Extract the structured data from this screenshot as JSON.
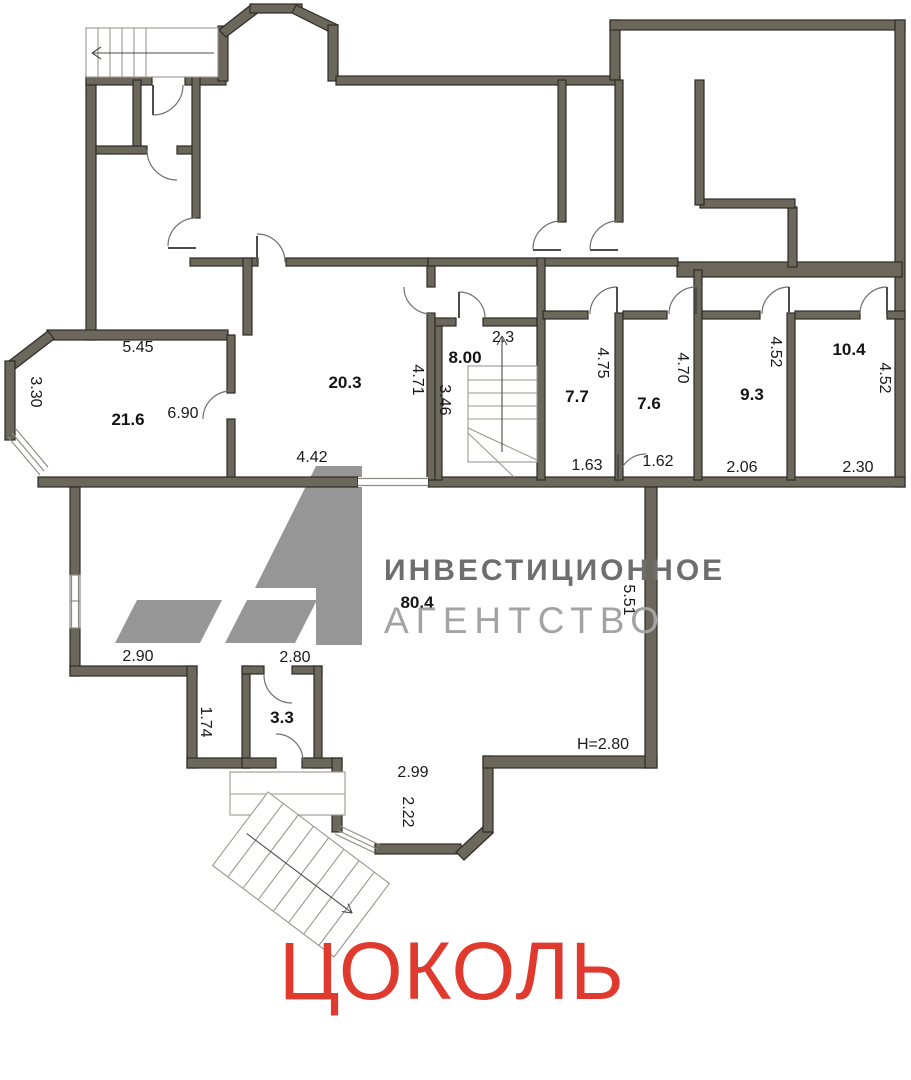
{
  "meta": {
    "floor_title": "ЦОКОЛЬ",
    "plan_type": "floor-plan"
  },
  "watermark": {
    "logo": "A1",
    "brand_line1": "ИНВЕСТИЦИОННОЕ",
    "brand_line2": "АГЕНТСТВО"
  },
  "colors": {
    "wall_fill": "#6b675a",
    "wall_outline": "#2e2c27",
    "title_red": "#e03a2f",
    "logo_gray": "#8e8e8e",
    "brand_dark_gray": "#6e6e6e",
    "brand_light_gray": "#a3a3a3",
    "label_text": "#141414"
  },
  "rooms": [
    {
      "area": "21.6",
      "x": 128,
      "y": 420
    },
    {
      "area": "20.3",
      "x": 345,
      "y": 383
    },
    {
      "area": "8.00",
      "x": 465,
      "y": 358
    },
    {
      "area": "7.7",
      "x": 577,
      "y": 397
    },
    {
      "area": "7.6",
      "x": 649,
      "y": 404
    },
    {
      "area": "9.3",
      "x": 752,
      "y": 395
    },
    {
      "area": "10.4",
      "x": 849,
      "y": 350
    },
    {
      "area": "80.4",
      "x": 417,
      "y": 603
    },
    {
      "area": "3.3",
      "x": 282,
      "y": 718
    }
  ],
  "dimensions": [
    {
      "value": "5.45",
      "x": 138,
      "y": 348,
      "vertical": false
    },
    {
      "value": "3.30",
      "x": 35,
      "y": 392,
      "vertical": true
    },
    {
      "value": "6.90",
      "x": 183,
      "y": 414,
      "vertical": false
    },
    {
      "value": "4.42",
      "x": 312,
      "y": 458,
      "vertical": false
    },
    {
      "value": "4.71",
      "x": 417,
      "y": 380,
      "vertical": true
    },
    {
      "value": "3.46",
      "x": 444,
      "y": 400,
      "vertical": true
    },
    {
      "value": "2.3",
      "x": 503,
      "y": 338,
      "vertical": false
    },
    {
      "value": "4.75",
      "x": 602,
      "y": 363,
      "vertical": true
    },
    {
      "value": "1.63",
      "x": 587,
      "y": 466,
      "vertical": false
    },
    {
      "value": "4.70",
      "x": 682,
      "y": 368,
      "vertical": true
    },
    {
      "value": "1.62",
      "x": 658,
      "y": 462,
      "vertical": false
    },
    {
      "value": "4.52",
      "x": 775,
      "y": 352,
      "vertical": true
    },
    {
      "value": "2.06",
      "x": 742,
      "y": 468,
      "vertical": false
    },
    {
      "value": "4.52",
      "x": 884,
      "y": 378,
      "vertical": true
    },
    {
      "value": "2.30",
      "x": 858,
      "y": 468,
      "vertical": false
    },
    {
      "value": "5.51",
      "x": 628,
      "y": 600,
      "vertical": true
    },
    {
      "value": "2.90",
      "x": 138,
      "y": 657,
      "vertical": false
    },
    {
      "value": "1.74",
      "x": 205,
      "y": 722,
      "vertical": true
    },
    {
      "value": "2.80",
      "x": 295,
      "y": 658,
      "vertical": false
    },
    {
      "value": "2.99",
      "x": 413,
      "y": 773,
      "vertical": false
    },
    {
      "value": "2.22",
      "x": 407,
      "y": 812,
      "vertical": true
    },
    {
      "value": "Н=2.80",
      "x": 603,
      "y": 745,
      "vertical": false
    }
  ]
}
